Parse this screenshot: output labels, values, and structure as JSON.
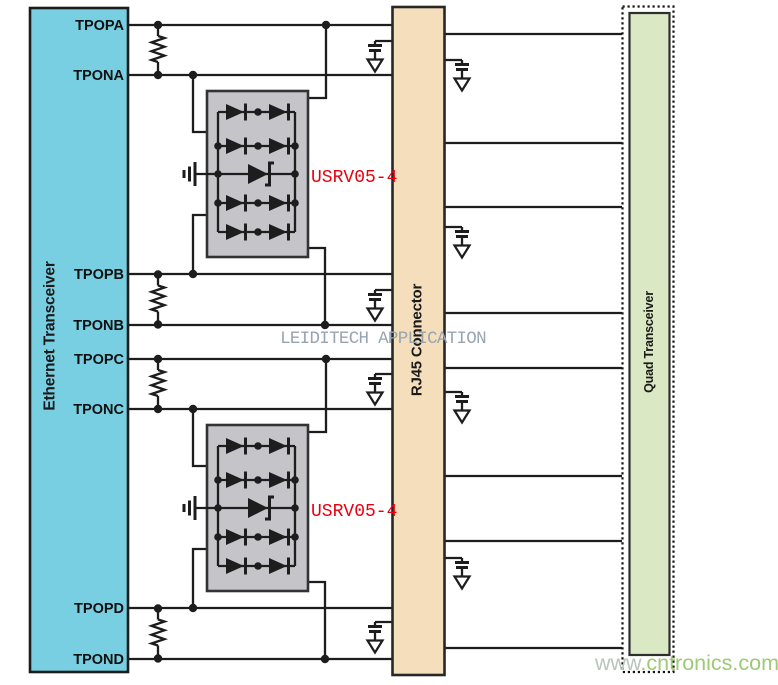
{
  "blocks": {
    "ethernet_transceiver": {
      "label": "Ethernet Transceiver",
      "pins": [
        "TPOPA",
        "TPONA",
        "TPOPB",
        "TPONB",
        "TPOPC",
        "TPONC",
        "TPOPD",
        "TPOND"
      ]
    },
    "rj45_connector": {
      "label": "RJ45 Connector"
    },
    "quad_transceiver": {
      "label": "Quad Transceiver"
    }
  },
  "tvs_arrays": [
    {
      "part": "USRV05-4"
    },
    {
      "part": "USRV05-4"
    }
  ],
  "watermarks": {
    "center": "LEIDITECH APPLICATION",
    "site_www": "www",
    "site_domain": ".cntronics.com"
  },
  "symbols": [
    "termination-resistor",
    "center-tap-capacitor-to-ground",
    "steering-diode-pair",
    "tvs-zener-diode",
    "chassis-ground"
  ],
  "colors": {
    "ethernet": "#79cfe2",
    "rj45": "#f5debc",
    "quad": "#dae8c3",
    "tvs_box": "#c5c5c9",
    "wire": "#1d1d1d",
    "part_label": "#e8000f",
    "watermark_app": "#98a5b1",
    "watermark_site": "#9cca77",
    "watermark_site_www": "#b9c4bd"
  }
}
